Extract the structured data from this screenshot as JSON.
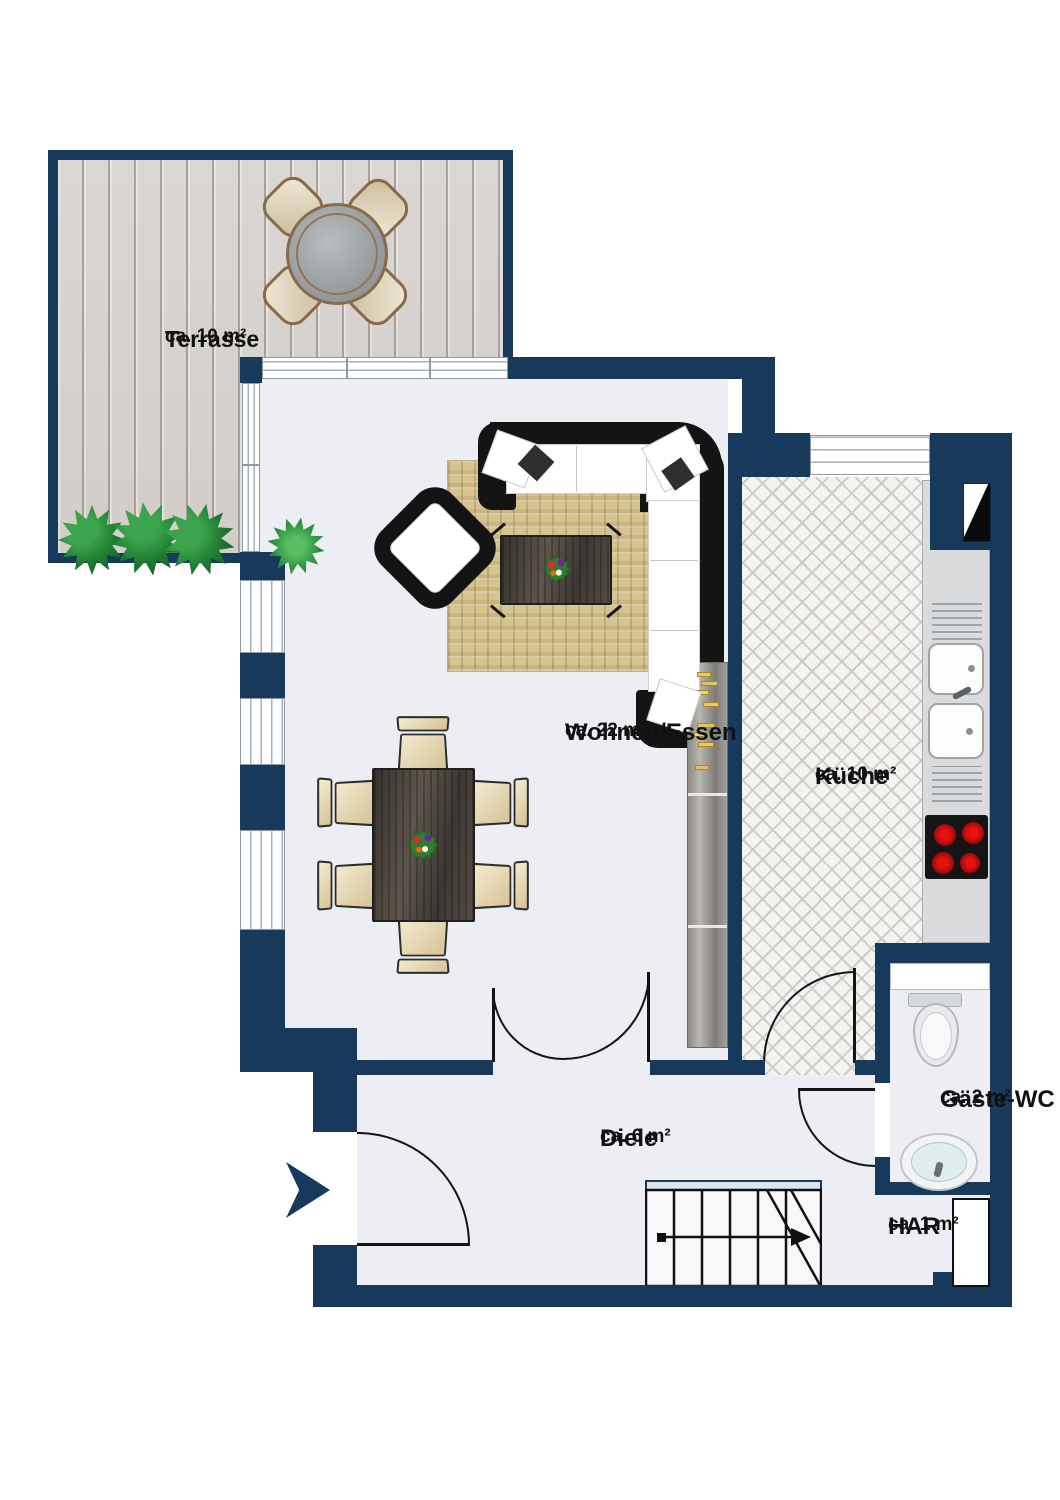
{
  "title": "Grundriss Erdgeschoss",
  "rooms": [
    {
      "name": "Terrasse",
      "area": "ca. 10 m²"
    },
    {
      "name": "Wohnen/Essen",
      "area": "ca. 22 m²"
    },
    {
      "name": "Küche",
      "area": "ca. 10 m²"
    },
    {
      "name": "Gäste-WC",
      "area": "ca. 2 m²"
    },
    {
      "name": "Diele",
      "area": "ca. 6 m²"
    },
    {
      "name": "HAR",
      "area": "ca. 1 m²"
    }
  ],
  "colors": {
    "wall": "#17395C",
    "floor": "#ECEEF4",
    "deck": "#D8D4D1",
    "tile": "#F4F3F1",
    "rug": "#D6C490",
    "burner": "#CC1111"
  },
  "icons": {
    "entrance": "entrance-arrow-icon",
    "stairs_direction": "stairs-up-arrow-icon"
  }
}
